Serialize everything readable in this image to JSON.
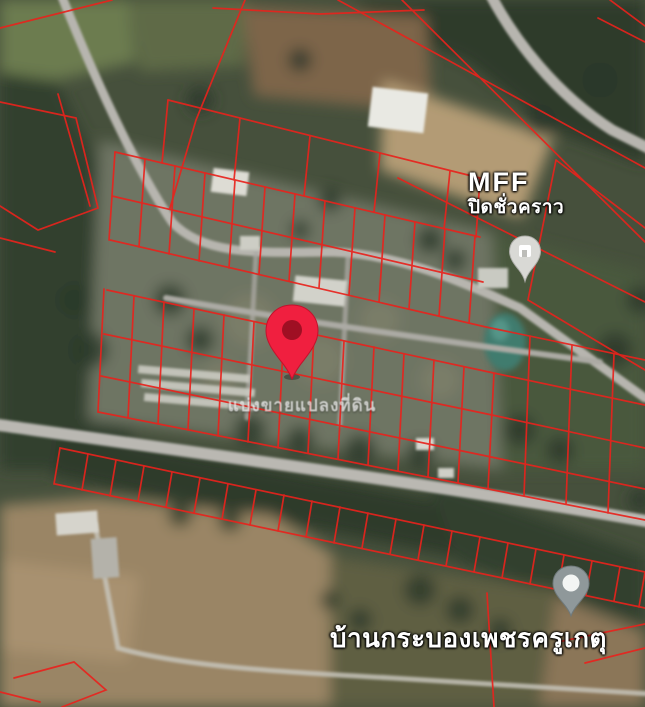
{
  "map": {
    "view": "satellite",
    "colors": {
      "parcel_boundary": "#e8231d",
      "selected_pin": "#f01f3f",
      "poi_pin_gray": "#8e989a",
      "label_text": "#ffffff"
    },
    "selected_place": {
      "caption": "แบ่งขายแปลงที่ดิน"
    },
    "pois": [
      {
        "title": "MFF",
        "status": "ปิดชั่วคราว",
        "icon": "store-pin"
      },
      {
        "title": "บ้านกระบองเพชรครูเกตุ",
        "icon": "place-pin"
      }
    ]
  }
}
